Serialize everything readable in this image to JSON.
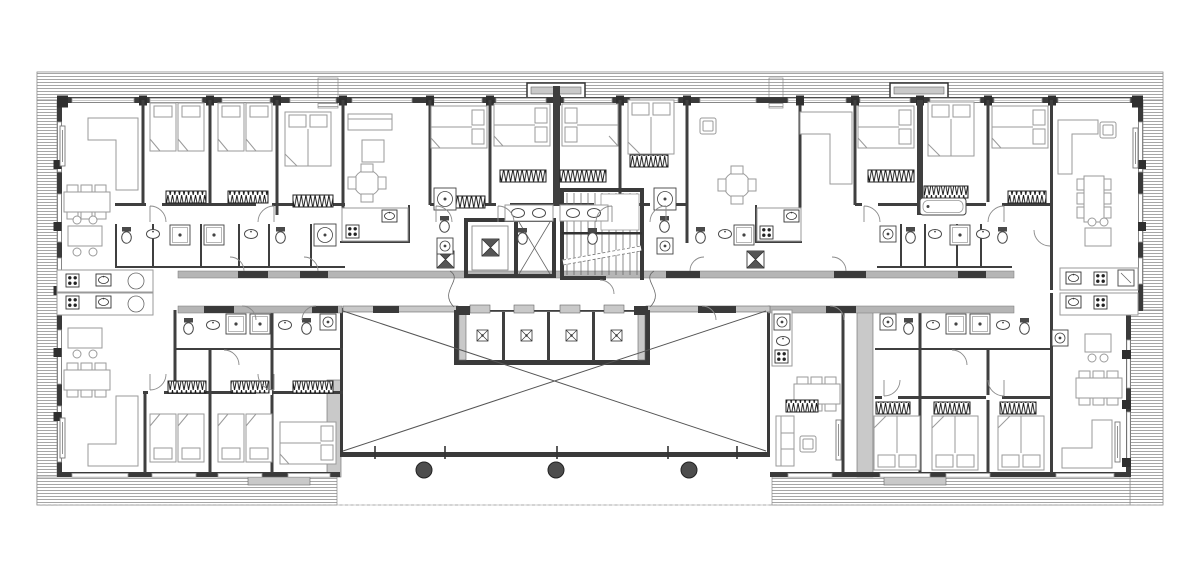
{
  "scene": {
    "aria_label": "apartment-building-floor-plan",
    "colors": {
      "wall": "#3a3a3a",
      "wall_light": "#b5b5b5",
      "sill": "#c9c9c9",
      "furniture": "#9a9a9a",
      "fixture": "#4a4a4a",
      "hatch": "#9c9c9c",
      "line": "#555555",
      "column": "#4d4d4d",
      "background": "#ffffff"
    },
    "counts": {
      "columns": 3,
      "elevator_bank_cells": 4,
      "core_elevator_shafts": 2,
      "stair_flights": 2,
      "balcony_hatch_bands": 6
    },
    "columns_x": [
      424,
      556,
      689
    ],
    "columns_y": 470,
    "titles": {
      "plan": "floor plan",
      "balconies": "balcony hatch bands",
      "walls": "walls",
      "windows": "windows",
      "corridor": "corridor",
      "core": "stair and elevator core",
      "elevator_bank": "elevator bank",
      "terrace": "terrace with cross bracing",
      "columns": "columns",
      "furniture": "furniture",
      "bathrooms": "bathroom fixtures",
      "doors": "door swings"
    },
    "legend_icons": [
      "single-bed",
      "double-bed",
      "sofa",
      "armchair",
      "dining-table",
      "round-table",
      "kitchen-island",
      "stove",
      "kitchen-sink",
      "fridge",
      "toilet",
      "wash-basin",
      "bathtub",
      "shower",
      "washing-machine",
      "wardrobe",
      "door-swing",
      "window",
      "stairs",
      "elevator",
      "ventilation-shaft",
      "column"
    ]
  }
}
